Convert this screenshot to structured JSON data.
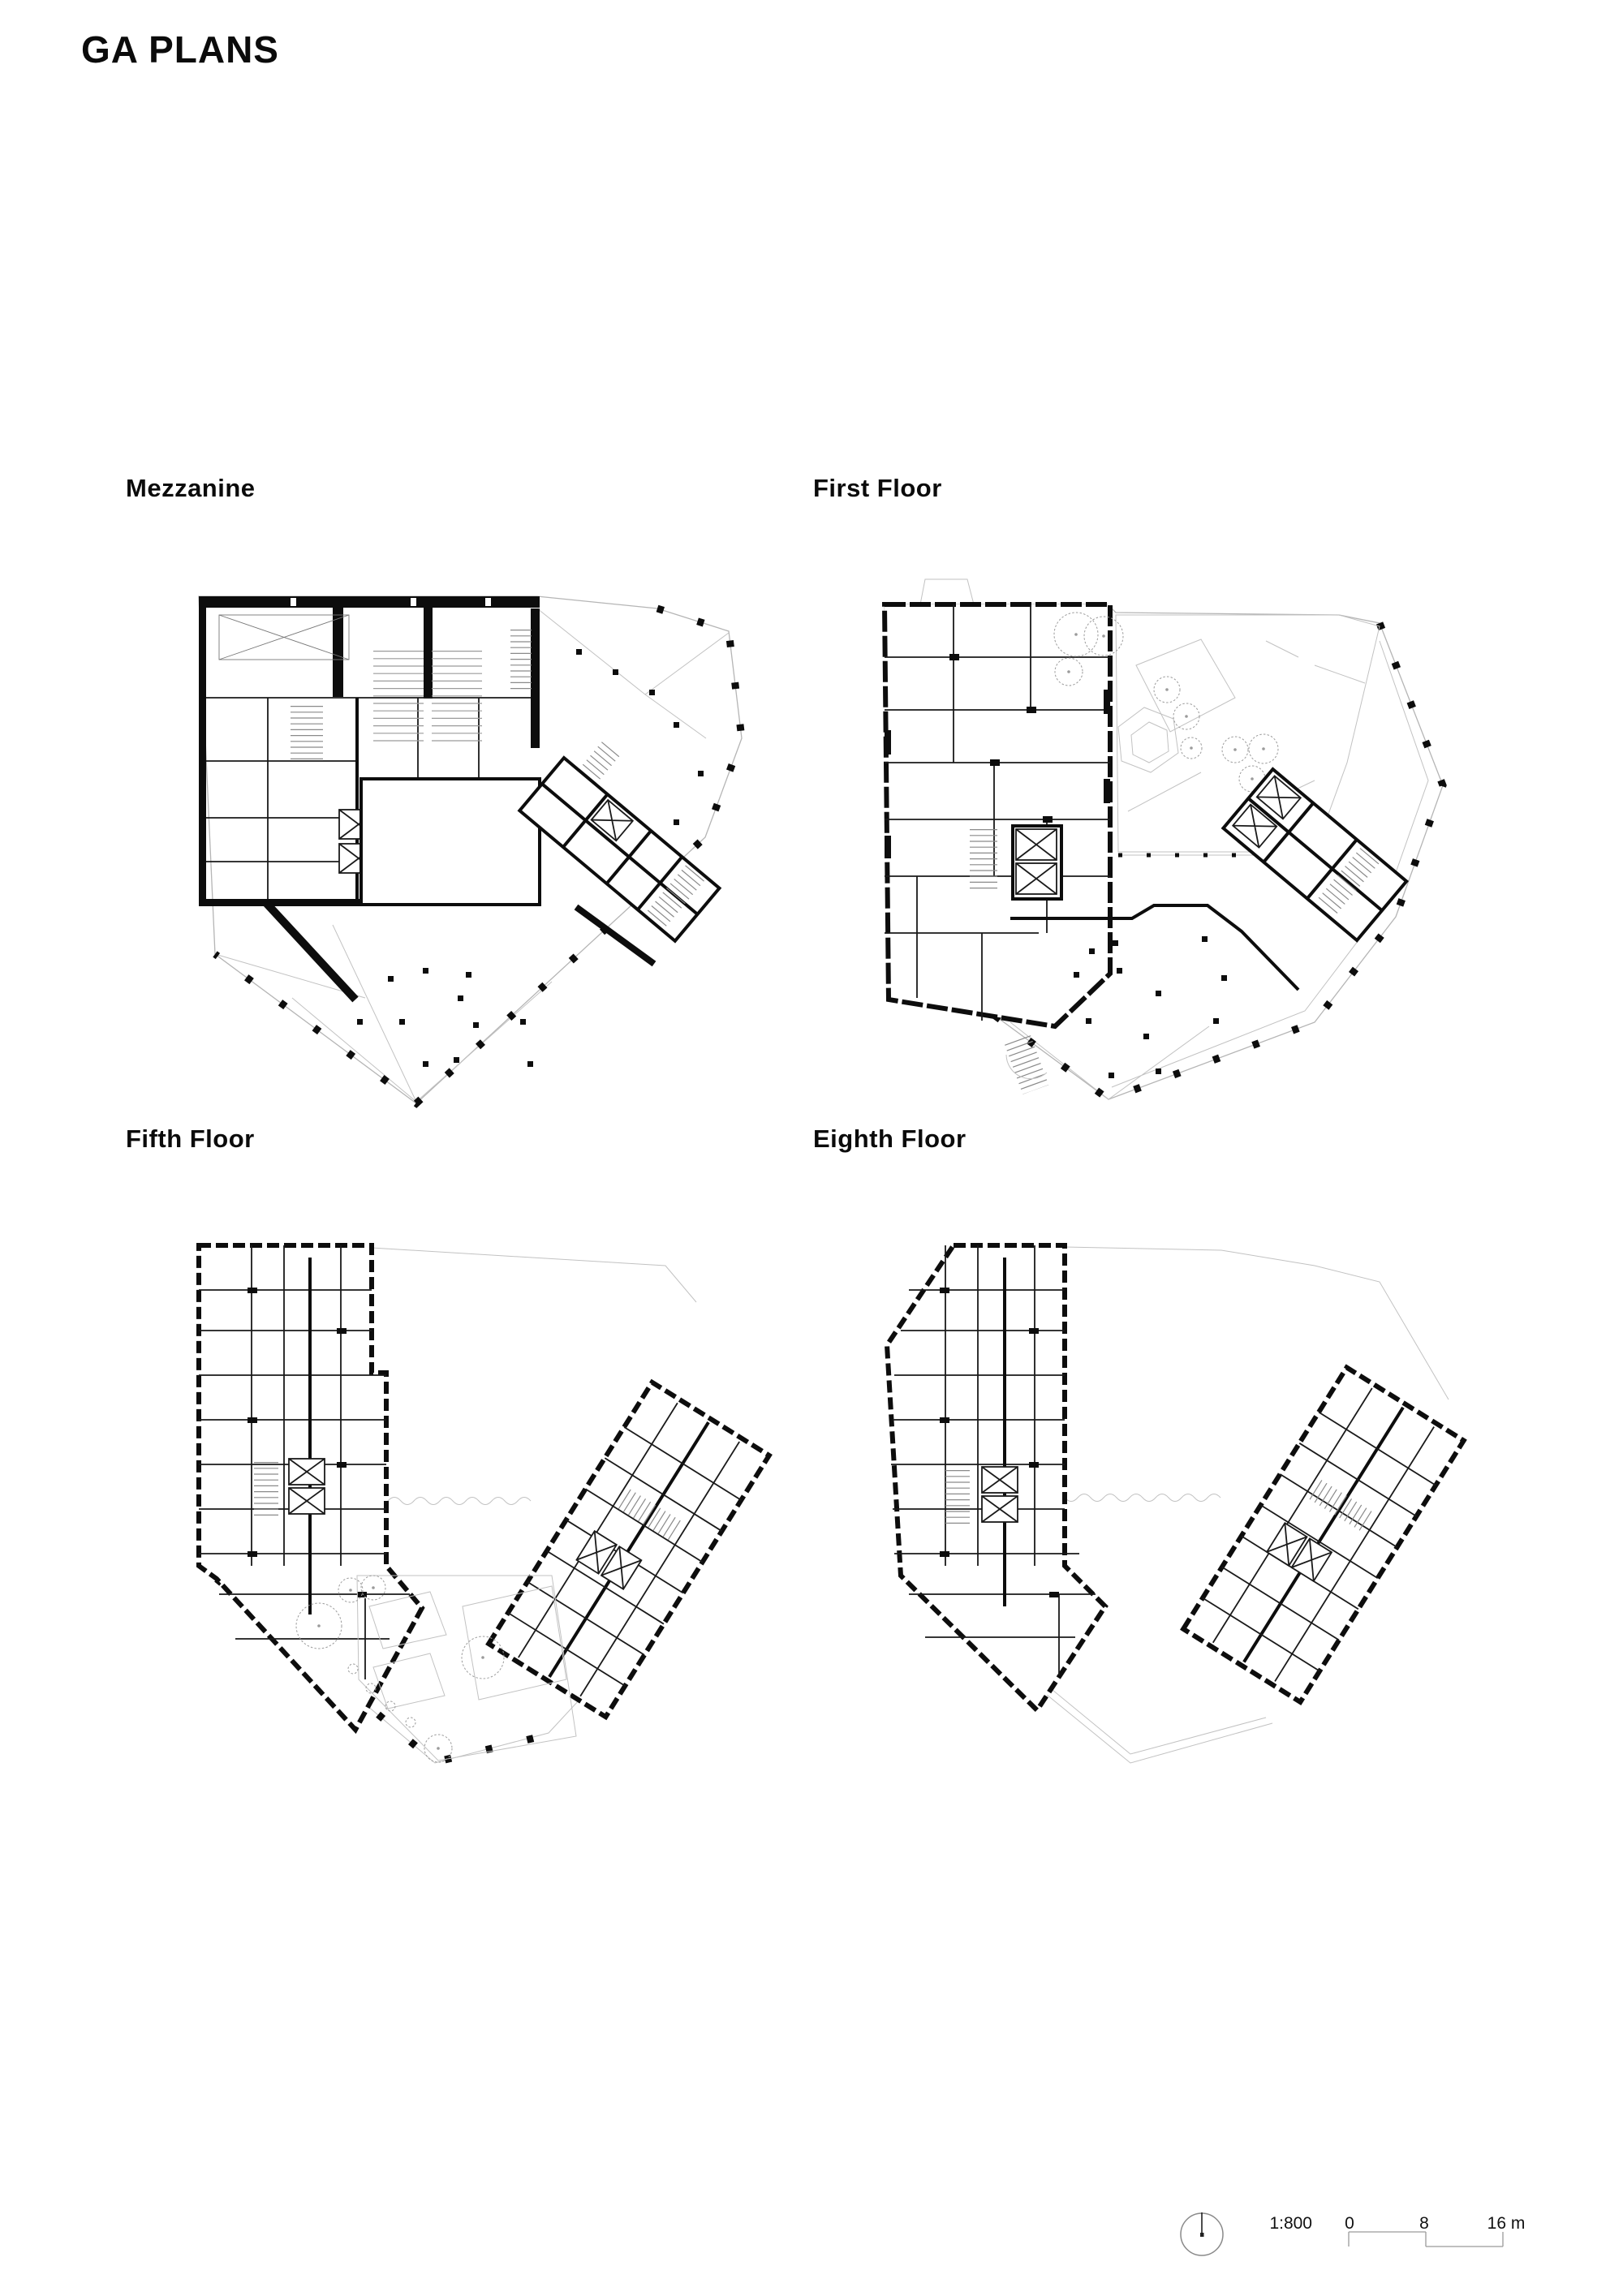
{
  "page": {
    "title": "GA PLANS"
  },
  "plans": [
    {
      "id": "mezzanine",
      "label": "Mezzanine"
    },
    {
      "id": "first-floor",
      "label": "First Floor"
    },
    {
      "id": "fifth-floor",
      "label": "Fifth Floor"
    },
    {
      "id": "eighth-floor",
      "label": "Eighth Floor"
    }
  ],
  "scale_bar": {
    "ratio": "1:800",
    "zero": "0",
    "mid": "8",
    "end": "16 m",
    "icon": "north-arrow-icon"
  },
  "colors": {
    "ink": "#0b0b0b",
    "drawing_gray": "#9a9a9a",
    "site_gray": "#b5b5b5"
  }
}
